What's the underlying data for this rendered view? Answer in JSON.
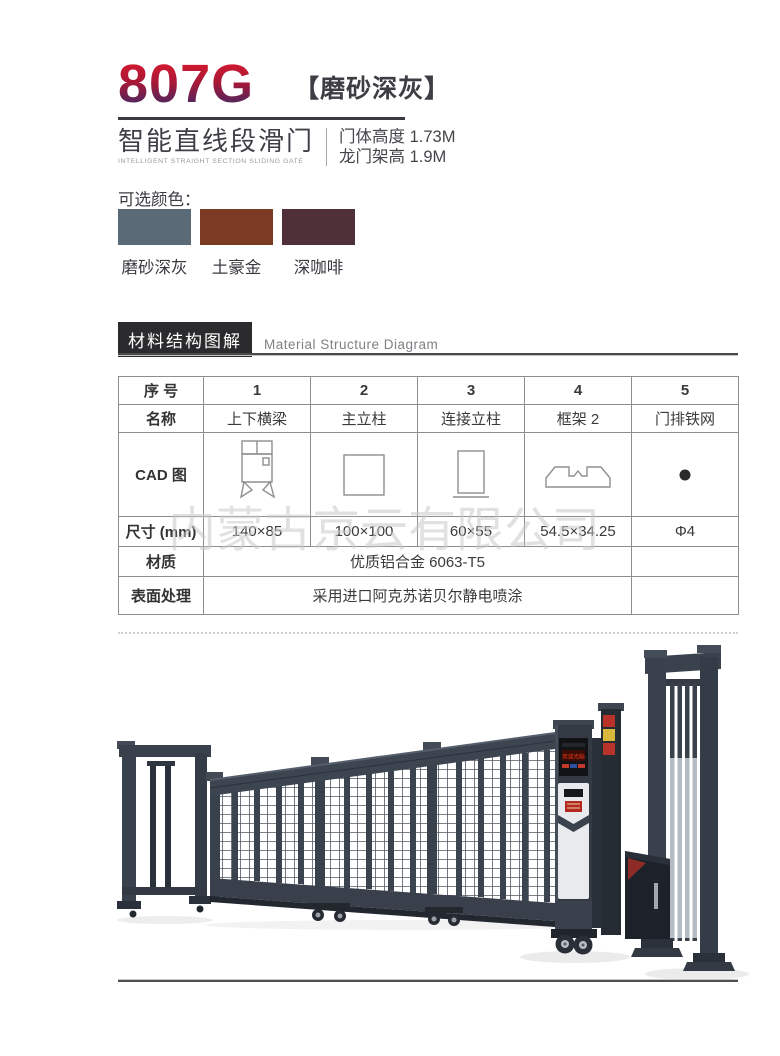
{
  "header": {
    "model": "807G",
    "variant": "【磨砂深灰】",
    "product_name_cn": "智能直线段滑门",
    "product_name_en": "INTELLIGENT STRAIGHT SECTION SLIDING GATE",
    "spec_door_height": "门体高度 1.73M",
    "spec_frame_height": "龙门架高 1.9M"
  },
  "color_options": {
    "label": "可选颜色：",
    "swatches": [
      {
        "name": "磨砂深灰",
        "hex": "#5a6a76"
      },
      {
        "name": "土豪金",
        "hex": "#7b3a22"
      },
      {
        "name": "深咖啡",
        "hex": "#4f3039"
      }
    ]
  },
  "section": {
    "title_cn": "材料结构图解",
    "title_en": "Material Structure Diagram"
  },
  "table": {
    "rows": {
      "index": {
        "label": "序 号",
        "values": [
          "1",
          "2",
          "3",
          "4",
          "5"
        ]
      },
      "name": {
        "label": "名称",
        "values": [
          "上下横梁",
          "主立柱",
          "连接立柱",
          "框架 2",
          "门排铁网"
        ]
      },
      "cad": {
        "label": "CAD 图",
        "icons": [
          "beam-profile-icon",
          "square-post-icon",
          "connect-post-icon",
          "frame2-profile-icon",
          "mesh-wire-dot-icon"
        ]
      },
      "size": {
        "label": "尺寸 (mm)",
        "values": [
          "140×85",
          "100×100",
          "60×55",
          "54.5×34.25",
          "Φ4"
        ]
      },
      "material": {
        "label": "材质",
        "value": "优质铝合金 6063-T5"
      },
      "surface": {
        "label": "表面处理",
        "value": "采用进口阿克苏诺贝尔静电喷涂"
      }
    }
  },
  "watermark": "内蒙古京云有限公司",
  "product_image": {
    "led_text": "欢迎光临"
  },
  "colors": {
    "accent_red": "#e31a2c",
    "accent_blue": "#2f2c6e",
    "gate_body": "#3a424e",
    "title_box_bg": "#2b2b2d"
  }
}
